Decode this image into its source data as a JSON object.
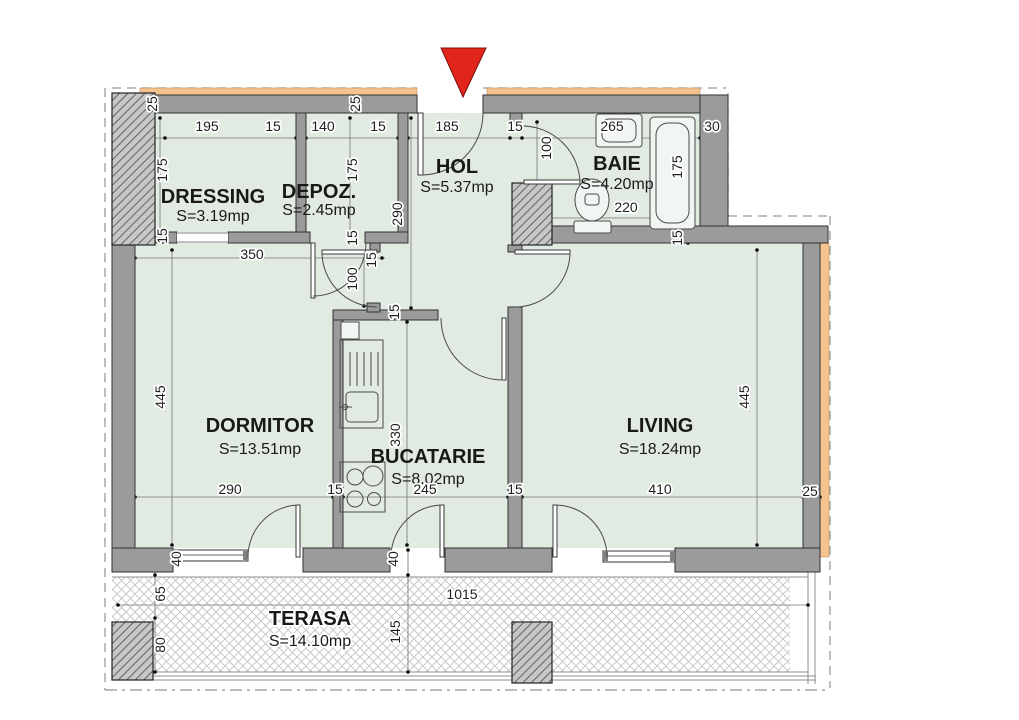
{
  "title": "Apartment floor plan",
  "colors": {
    "floor": "#e2ebe1",
    "wall": "#9b9b9b",
    "insulation": "#f5c48e",
    "entrance_marker": "#e2251c",
    "terrace_hatch": "#c2c2c2"
  },
  "icons": {
    "entrance_marker": "red-triangle-down",
    "bath_fixtures": [
      "sink",
      "toilet",
      "bathtub"
    ],
    "kitchen_fixtures": [
      "counter-sink",
      "stove"
    ]
  },
  "rooms": [
    {
      "name": "DRESSING",
      "area": "S=3.19mp"
    },
    {
      "name": "DEPOZ.",
      "area": "S=2.45mp"
    },
    {
      "name": "HOL",
      "area": "S=5.37mp"
    },
    {
      "name": "BAIE",
      "area": "S=4.20mp"
    },
    {
      "name": "DORMITOR",
      "area": "S=13.51mp"
    },
    {
      "name": "BUCATARIE",
      "area": "S=8.02mp"
    },
    {
      "name": "LIVING",
      "area": "S=18.24mp"
    },
    {
      "name": "TERASA",
      "area": "S=14.10mp"
    }
  ],
  "dims": [
    {
      "t": "25"
    },
    {
      "t": "195"
    },
    {
      "t": "15"
    },
    {
      "t": "140"
    },
    {
      "t": "15"
    },
    {
      "t": "185"
    },
    {
      "t": "15"
    },
    {
      "t": "265"
    },
    {
      "t": "30"
    },
    {
      "t": "25"
    },
    {
      "t": "175"
    },
    {
      "t": "175"
    },
    {
      "t": "100"
    },
    {
      "t": "175"
    },
    {
      "t": "220"
    },
    {
      "t": "15"
    },
    {
      "t": "290"
    },
    {
      "t": "15"
    },
    {
      "t": "350"
    },
    {
      "t": "15"
    },
    {
      "t": "100"
    },
    {
      "t": "15"
    },
    {
      "t": "15"
    },
    {
      "t": "445"
    },
    {
      "t": "445"
    },
    {
      "t": "330"
    },
    {
      "t": "290"
    },
    {
      "t": "15"
    },
    {
      "t": "245"
    },
    {
      "t": "15"
    },
    {
      "t": "410"
    },
    {
      "t": "25"
    },
    {
      "t": "40"
    },
    {
      "t": "40"
    },
    {
      "t": "65"
    },
    {
      "t": "80"
    },
    {
      "t": "1015"
    },
    {
      "t": "145"
    }
  ]
}
